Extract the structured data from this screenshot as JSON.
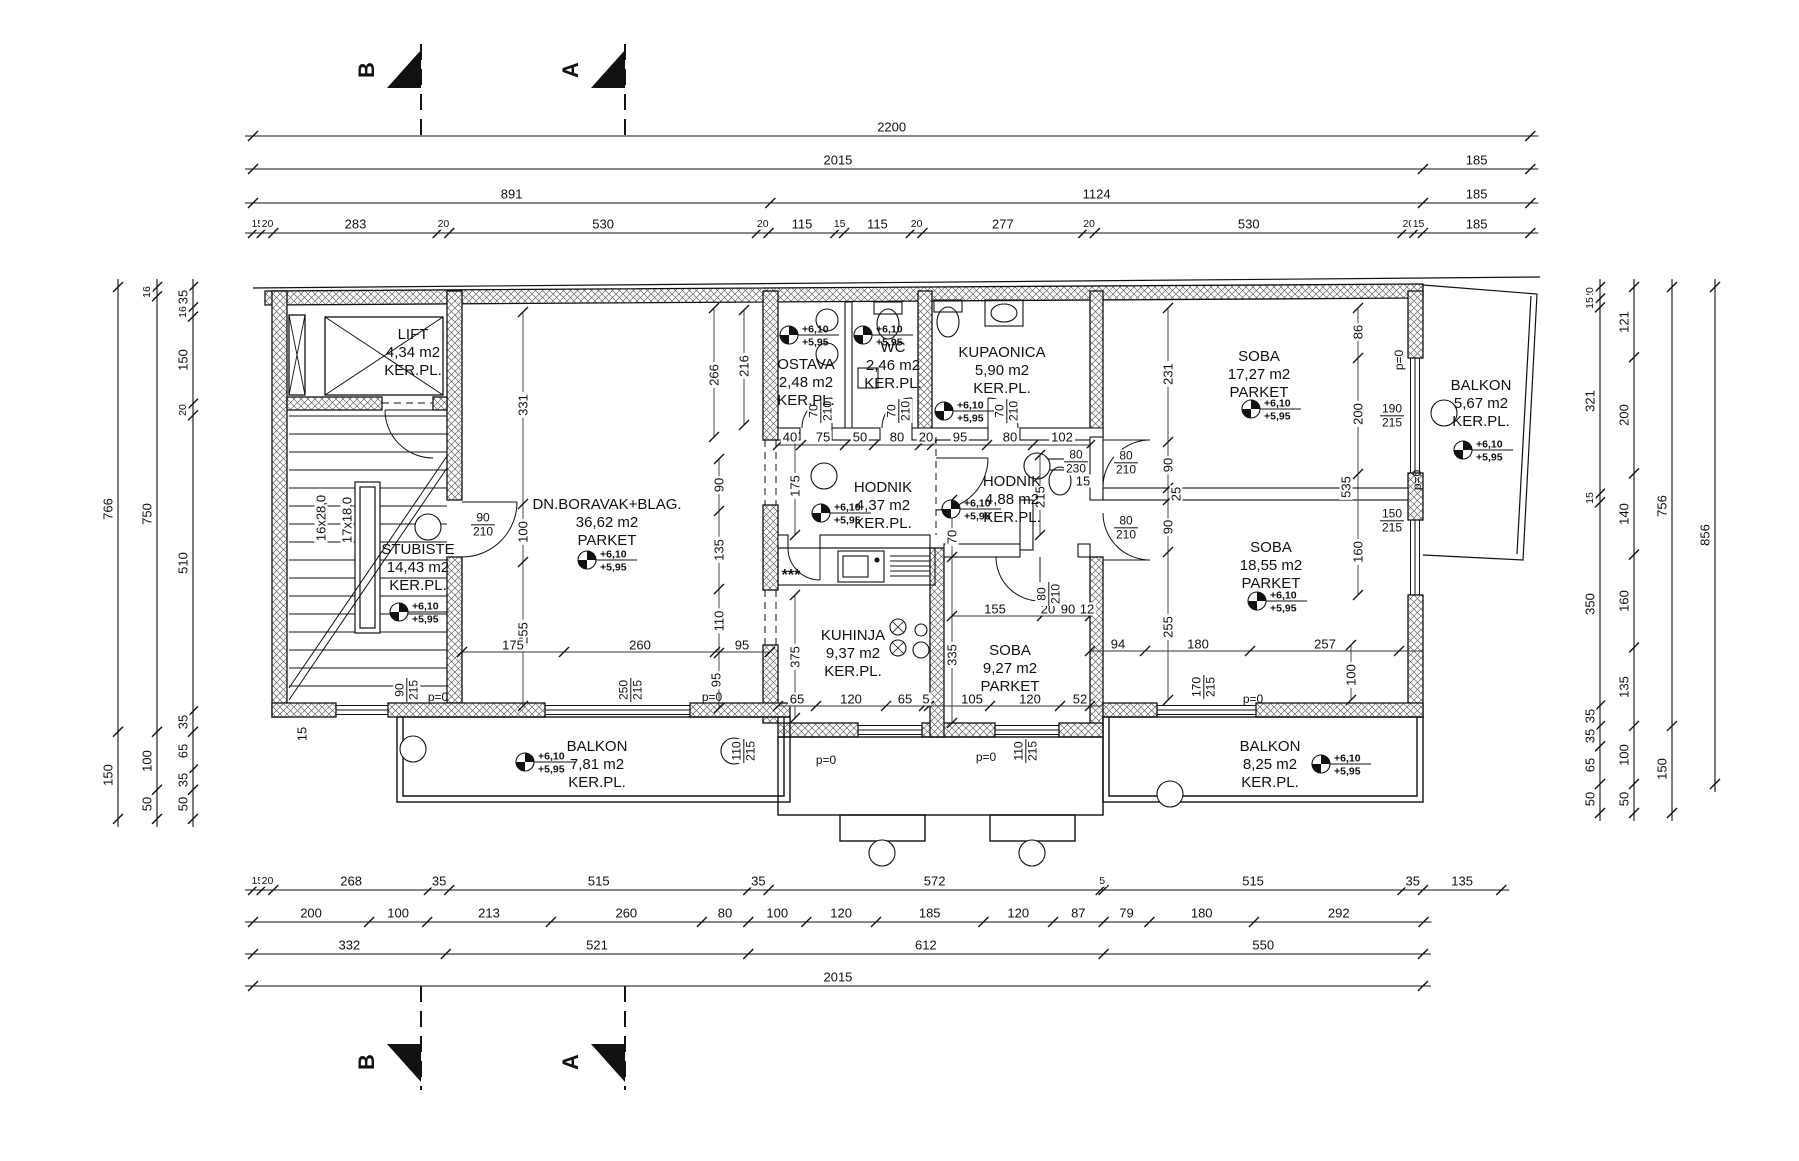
{
  "canvas": {
    "w": 1799,
    "h": 1161
  },
  "colors": {
    "ink": "#111111",
    "hatch": "#666666",
    "paper": "#ffffff"
  },
  "section_markers": {
    "top": [
      {
        "label": "B",
        "x": 421
      },
      {
        "label": "A",
        "x": 625
      }
    ],
    "bottom": [
      {
        "label": "B",
        "x": 421
      },
      {
        "label": "A",
        "x": 625
      }
    ]
  },
  "level_values": {
    "top": "+6,10",
    "bottom": "+5,95"
  },
  "dim_chains": {
    "top": [
      {
        "y": 136,
        "segs": [
          "2200"
        ]
      },
      {
        "y": 169,
        "segs": [
          "2015",
          "185"
        ]
      },
      {
        "y": 203,
        "segs": [
          "891",
          "1124",
          "185"
        ]
      },
      {
        "y": 233,
        "segs": [
          "15",
          "20",
          "283",
          "20",
          "530",
          "20",
          "115",
          "15",
          "115",
          "20",
          "277",
          "20",
          "530",
          "20",
          "15",
          "185"
        ]
      }
    ],
    "bottom": [
      {
        "y": 890,
        "segs": [
          "15",
          "20",
          "268",
          "35",
          "515",
          "35",
          "572",
          "5",
          "515",
          "35",
          "135"
        ]
      },
      {
        "y": 922,
        "segs": [
          "200",
          "100",
          "213",
          "260",
          "80",
          "100",
          "120",
          "185",
          "120",
          "87",
          "79",
          "180",
          "292"
        ]
      },
      {
        "y": 954,
        "segs": [
          "332",
          "521",
          "612",
          "550"
        ]
      },
      {
        "y": 986,
        "segs": [
          "2015"
        ]
      }
    ],
    "left": [
      {
        "x": 118,
        "segs": [
          "766",
          "150"
        ]
      },
      {
        "x": 157,
        "segs": [
          "16",
          "750",
          "100",
          "50"
        ]
      },
      {
        "x": 193,
        "segs": [
          "35",
          "16",
          "150",
          "20",
          "510",
          "35",
          "65",
          "35",
          "50"
        ]
      }
    ],
    "right": [
      {
        "x": 1600,
        "segs": [
          "20",
          "15",
          "321",
          "15",
          "350",
          "35",
          "35",
          "65",
          "50"
        ]
      },
      {
        "x": 1634,
        "segs": [
          "121",
          "200",
          "140",
          "160",
          "135",
          "100",
          "50"
        ]
      },
      {
        "x": 1672,
        "segs": [
          "756",
          "150"
        ]
      },
      {
        "x": 1715,
        "segs": [
          "856"
        ]
      }
    ]
  },
  "rooms": [
    {
      "name": "LIFT",
      "area": "4,34 m2",
      "floor": "KER.PL.",
      "cx": 413,
      "cy": 353,
      "level": false
    },
    {
      "name": "STUBISTE",
      "area": "14,43 m2",
      "floor": "KER.PL.",
      "cx": 418,
      "cy": 568,
      "level": true,
      "lx": 398,
      "ly": 612
    },
    {
      "name": "DN.BORAVAK+BLAG.",
      "area": "36,62 m2",
      "floor": "PARKET",
      "cx": 607,
      "cy": 523,
      "level": true,
      "lx": 586,
      "ly": 560
    },
    {
      "name": "OSTAVA",
      "area": "2,48 m2",
      "floor": "KER.PL.",
      "cx": 806,
      "cy": 383,
      "level": true,
      "lx": 788,
      "ly": 335
    },
    {
      "name": "WC",
      "area": "2,46 m2",
      "floor": "KER.PL.",
      "cx": 893,
      "cy": 366,
      "level": true,
      "lx": 862,
      "ly": 335
    },
    {
      "name": "KUPAONICA",
      "area": "5,90 m2",
      "floor": "KER.PL.",
      "cx": 1002,
      "cy": 371,
      "level": true,
      "lx": 943,
      "ly": 411
    },
    {
      "name": "HODNIK",
      "area": "4,37 m2",
      "floor": "KER.PL.",
      "cx": 883,
      "cy": 506,
      "level": true,
      "lx": 820,
      "ly": 513
    },
    {
      "name": "HODNIK",
      "area": "4,88 m2",
      "floor": "KER.PL.",
      "cx": 1012,
      "cy": 500,
      "level": true,
      "lx": 950,
      "ly": 509
    },
    {
      "name": "SOBA",
      "area": "17,27 m2",
      "floor": "PARKET",
      "cx": 1259,
      "cy": 375,
      "level": true,
      "lx": 1250,
      "ly": 409
    },
    {
      "name": "BALKON",
      "area": "5,67 m2",
      "floor": "KER.PL.",
      "cx": 1481,
      "cy": 404,
      "level": true,
      "lx": 1462,
      "ly": 450
    },
    {
      "name": "SOBA",
      "area": "18,55 m2",
      "floor": "PARKET",
      "cx": 1271,
      "cy": 566,
      "level": true,
      "lx": 1256,
      "ly": 601
    },
    {
      "name": "KUHINJA",
      "area": "9,37 m2",
      "floor": "KER.PL.",
      "cx": 853,
      "cy": 654,
      "level": false
    },
    {
      "name": "SOBA",
      "area": "9,27 m2",
      "floor": "PARKET",
      "cx": 1010,
      "cy": 669,
      "level": false
    },
    {
      "name": "BALKON",
      "area": "7,81 m2",
      "floor": "KER.PL.",
      "cx": 597,
      "cy": 765,
      "level": true,
      "lx": 524,
      "ly": 762
    },
    {
      "name": "BALKON",
      "area": "8,25 m2",
      "floor": "KER.PL.",
      "cx": 1270,
      "cy": 765,
      "level": true,
      "lx": 1320,
      "ly": 764
    }
  ],
  "stair_labels": [
    {
      "t": "16x28,0",
      "x": 321,
      "y": 518
    },
    {
      "t": "17x18,0",
      "x": 347,
      "y": 520
    }
  ],
  "misc_labels": [
    {
      "t": "***",
      "x": 791,
      "y": 576
    }
  ],
  "interior_dims": [
    [
      "331",
      523,
      405,
      1
    ],
    [
      "100",
      523,
      532,
      1
    ],
    [
      "255",
      523,
      633,
      1
    ],
    [
      "175",
      513,
      645,
      0
    ],
    [
      "260",
      640,
      645,
      0
    ],
    [
      "95",
      742,
      645,
      0
    ],
    [
      "266",
      714,
      375,
      1
    ],
    [
      "216",
      744,
      366,
      1
    ],
    [
      "90",
      719,
      485,
      1
    ],
    [
      "135",
      719,
      550,
      1
    ],
    [
      "110",
      719,
      621,
      1
    ],
    [
      "95",
      716,
      680,
      1
    ],
    [
      "15",
      302,
      734,
      1
    ],
    [
      "175",
      795,
      486,
      1
    ],
    [
      "375",
      795,
      657,
      1
    ],
    [
      "40",
      790,
      437,
      0
    ],
    [
      "75",
      823,
      437,
      0
    ],
    [
      "50",
      860,
      437,
      0
    ],
    [
      "80",
      897,
      437,
      0
    ],
    [
      "20",
      926,
      437,
      0
    ],
    [
      "95",
      960,
      437,
      0
    ],
    [
      "80",
      1010,
      437,
      0
    ],
    [
      "102",
      1062,
      437,
      0
    ],
    [
      "15",
      1083,
      481,
      0
    ],
    [
      "215",
      1040,
      497,
      1
    ],
    [
      "70",
      952,
      537,
      1
    ],
    [
      "335",
      952,
      655,
      1
    ],
    [
      "155",
      995,
      609,
      0
    ],
    [
      "20",
      1048,
      609,
      0
    ],
    [
      "90",
      1068,
      609,
      0
    ],
    [
      "12",
      1087,
      609,
      0
    ],
    [
      "65",
      797,
      699,
      0
    ],
    [
      "120",
      851,
      699,
      0
    ],
    [
      "65",
      905,
      699,
      0
    ],
    [
      "5",
      926,
      699,
      0
    ],
    [
      "105",
      972,
      699,
      0
    ],
    [
      "120",
      1030,
      699,
      0
    ],
    [
      "52",
      1080,
      699,
      0
    ],
    [
      "231",
      1168,
      374,
      1
    ],
    [
      "90",
      1168,
      465,
      1
    ],
    [
      "25",
      1176,
      494,
      1
    ],
    [
      "90",
      1168,
      527,
      1
    ],
    [
      "255",
      1168,
      627,
      1
    ],
    [
      "86",
      1358,
      332,
      1
    ],
    [
      "200",
      1358,
      414,
      1
    ],
    [
      "535",
      1346,
      487,
      1
    ],
    [
      "160",
      1358,
      552,
      1
    ],
    [
      "100",
      1351,
      675,
      1
    ],
    [
      "94",
      1118,
      644,
      0
    ],
    [
      "180",
      1198,
      644,
      0
    ],
    [
      "257",
      1325,
      644,
      0
    ]
  ],
  "openings": [
    {
      "num": "90",
      "den": "210",
      "x": 483,
      "y": 525,
      "r": 0
    },
    {
      "num": "70",
      "den": "210",
      "x": 821,
      "y": 411,
      "r": 1
    },
    {
      "num": "70",
      "den": "210",
      "x": 899,
      "y": 411,
      "r": 1
    },
    {
      "num": "70",
      "den": "210",
      "x": 1007,
      "y": 411,
      "r": 1
    },
    {
      "num": "80",
      "den": "230",
      "x": 1076,
      "y": 462,
      "r": 0
    },
    {
      "num": "80",
      "den": "210",
      "x": 1126,
      "y": 463,
      "r": 0
    },
    {
      "num": "80",
      "den": "210",
      "x": 1126,
      "y": 528,
      "r": 0
    },
    {
      "num": "80",
      "den": "210",
      "x": 1049,
      "y": 594,
      "r": 1
    },
    {
      "num": "90",
      "den": "215",
      "x": 407,
      "y": 690,
      "r": 1
    },
    {
      "num": "250",
      "den": "215",
      "x": 631,
      "y": 690,
      "r": 1
    },
    {
      "num": "110",
      "den": "215",
      "x": 744,
      "y": 751,
      "r": 1
    },
    {
      "num": "110",
      "den": "215",
      "x": 1026,
      "y": 751,
      "r": 1
    },
    {
      "num": "170",
      "den": "215",
      "x": 1204,
      "y": 687,
      "r": 1
    },
    {
      "num": "190",
      "den": "215",
      "x": 1392,
      "y": 416,
      "r": 0
    },
    {
      "num": "150",
      "den": "215",
      "x": 1392,
      "y": 521,
      "r": 0
    }
  ],
  "p0_labels": [
    {
      "t": "p=0",
      "x": 438,
      "y": 697,
      "r": 0
    },
    {
      "t": "p=0",
      "x": 712,
      "y": 697,
      "r": 0
    },
    {
      "t": "p=0",
      "x": 826,
      "y": 760,
      "r": 0
    },
    {
      "t": "p=0",
      "x": 986,
      "y": 757,
      "r": 0
    },
    {
      "t": "p=0",
      "x": 1253,
      "y": 699,
      "r": 0
    },
    {
      "t": "p=0",
      "x": 1399,
      "y": 360,
      "r": 1
    },
    {
      "t": "p=0",
      "x": 1417,
      "y": 480,
      "r": 1
    }
  ]
}
